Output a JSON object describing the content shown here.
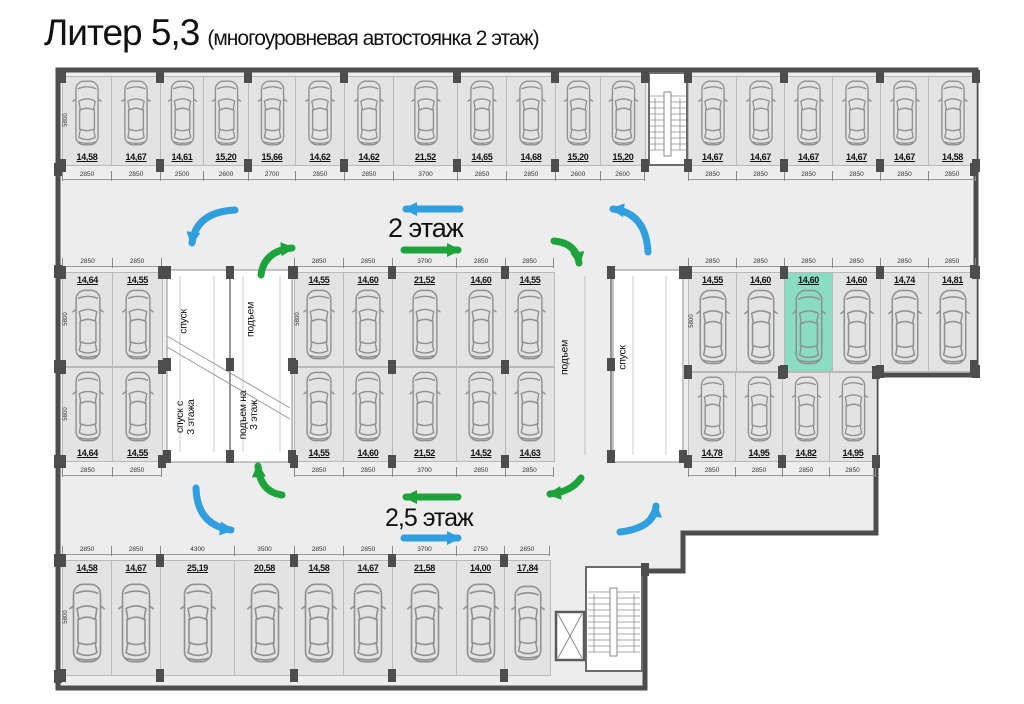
{
  "title": {
    "main": "Литер 5,3",
    "sub": "(многоуровневая автостоянка 2 этаж)"
  },
  "floor_labels": {
    "upper": "2 этаж",
    "lower": "2,5 этаж"
  },
  "ramps": {
    "left": {
      "lane1_top": "спуск",
      "lane2_top": "подъем",
      "lane1_bottom": "спуск с\n3 этажа",
      "lane2_bottom": "подъем на\n3 этаж"
    },
    "right": {
      "lane1": "подъем",
      "lane2": "спуск"
    }
  },
  "depth_dim": "5800",
  "colors": {
    "highlight": "#8BDCC5",
    "blue": "#2F9FE0",
    "green": "#1EA33C",
    "wall": "#4d4d4d"
  },
  "blocks": {
    "top_left": {
      "areas": [
        "14,58",
        "14,67",
        "14,61",
        "15,20",
        "15,66",
        "14,62",
        "14,62",
        "21,52",
        "14,65",
        "14,68",
        "15,20",
        "15,20"
      ],
      "dims": [
        "2850",
        "2850",
        "2500",
        "2600",
        "2700",
        "2850",
        "2850",
        "3700",
        "2850",
        "2850",
        "2600",
        "2600"
      ]
    },
    "top_right": {
      "areas": [
        "14,67",
        "14,67",
        "14,67",
        "14,67",
        "14,67",
        "14,58"
      ],
      "dims": [
        "2850",
        "2850",
        "2850",
        "2850",
        "2850",
        "2850"
      ]
    },
    "mid_left_top": {
      "areas": [
        "14,64",
        "14,55"
      ],
      "dims": [
        "2850",
        "2850"
      ]
    },
    "mid_left_bottom": {
      "areas": [
        "14,64",
        "14,55"
      ],
      "dims": [
        "2850",
        "2850"
      ]
    },
    "mid_center_top": {
      "areas": [
        "14,55",
        "14,60",
        "21,52",
        "14,60",
        "14,55"
      ],
      "dims": [
        "2850",
        "2850",
        "3700",
        "2850",
        "2850"
      ]
    },
    "mid_center_bottom": {
      "areas": [
        "14,55",
        "14,60",
        "21,52",
        "14,52",
        "14,63"
      ],
      "dims": [
        "2850",
        "2850",
        "3700",
        "2850",
        "2850"
      ]
    },
    "mid_right_top": {
      "areas": [
        "14,55",
        "14,60",
        "14,60",
        "14,60",
        "14,74",
        "14,81"
      ],
      "dims": [
        "2850",
        "2850",
        "2850",
        "2850",
        "2850",
        "2850"
      ]
    },
    "mid_right_bottom": {
      "areas": [
        "14,78",
        "14,95",
        "14,82",
        "14,95"
      ],
      "dims": [
        "2850",
        "2850",
        "2850",
        "2850"
      ]
    },
    "bottom": {
      "areas": [
        "14,58",
        "14,67",
        "25,19",
        "20,58",
        "14,58",
        "14,67",
        "21,58",
        "14,00",
        "17,84"
      ],
      "dims": [
        "2850",
        "2850",
        "4300",
        "3500",
        "2850",
        "2850",
        "3700",
        "2750",
        "2650"
      ]
    }
  }
}
